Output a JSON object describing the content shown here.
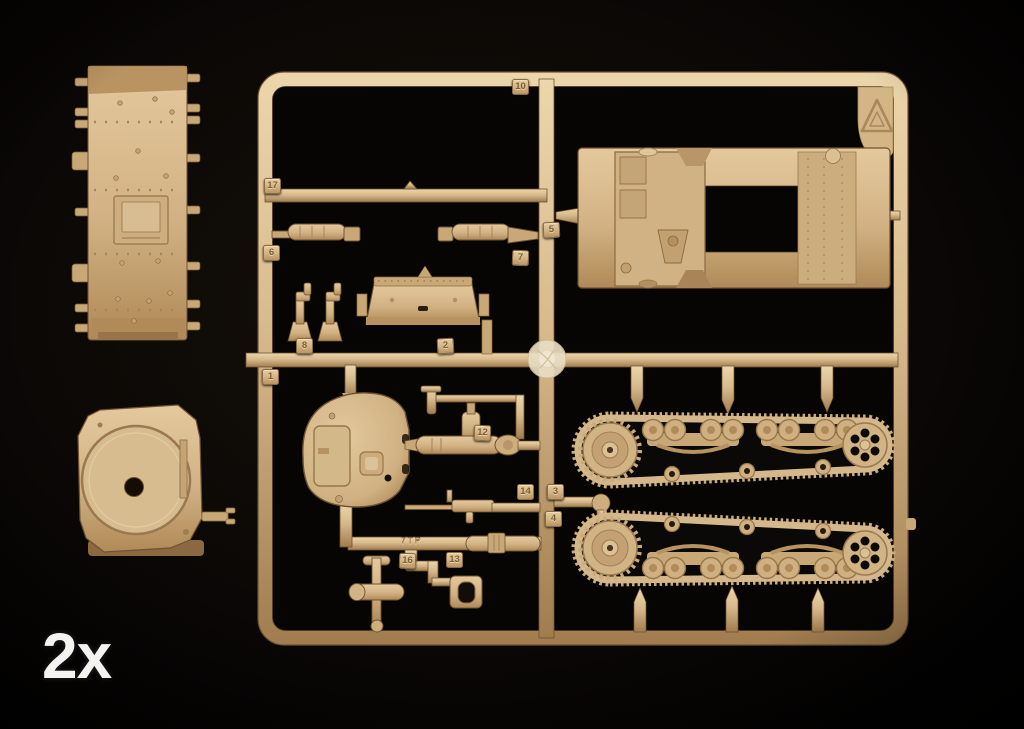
{
  "colors": {
    "background": "#050403",
    "plastic": "#d7ba8c",
    "plastic_dark": "#8f7048",
    "plastic_light": "#ecd8b2",
    "tag_text": "#7c5e38",
    "quantity_text": "#f5f3ef"
  },
  "quantity_label": "2x",
  "sprue": {
    "molded_text": "7TP",
    "corner_icon": "recycling-triangle-icon",
    "tags": {
      "1": "1",
      "2": "2",
      "3": "3",
      "4": "4",
      "5": "5",
      "6": "6",
      "7": "7",
      "8": "8",
      "10": "10",
      "12": "12",
      "13": "13",
      "14": "14",
      "16": "16",
      "17": "17"
    }
  }
}
